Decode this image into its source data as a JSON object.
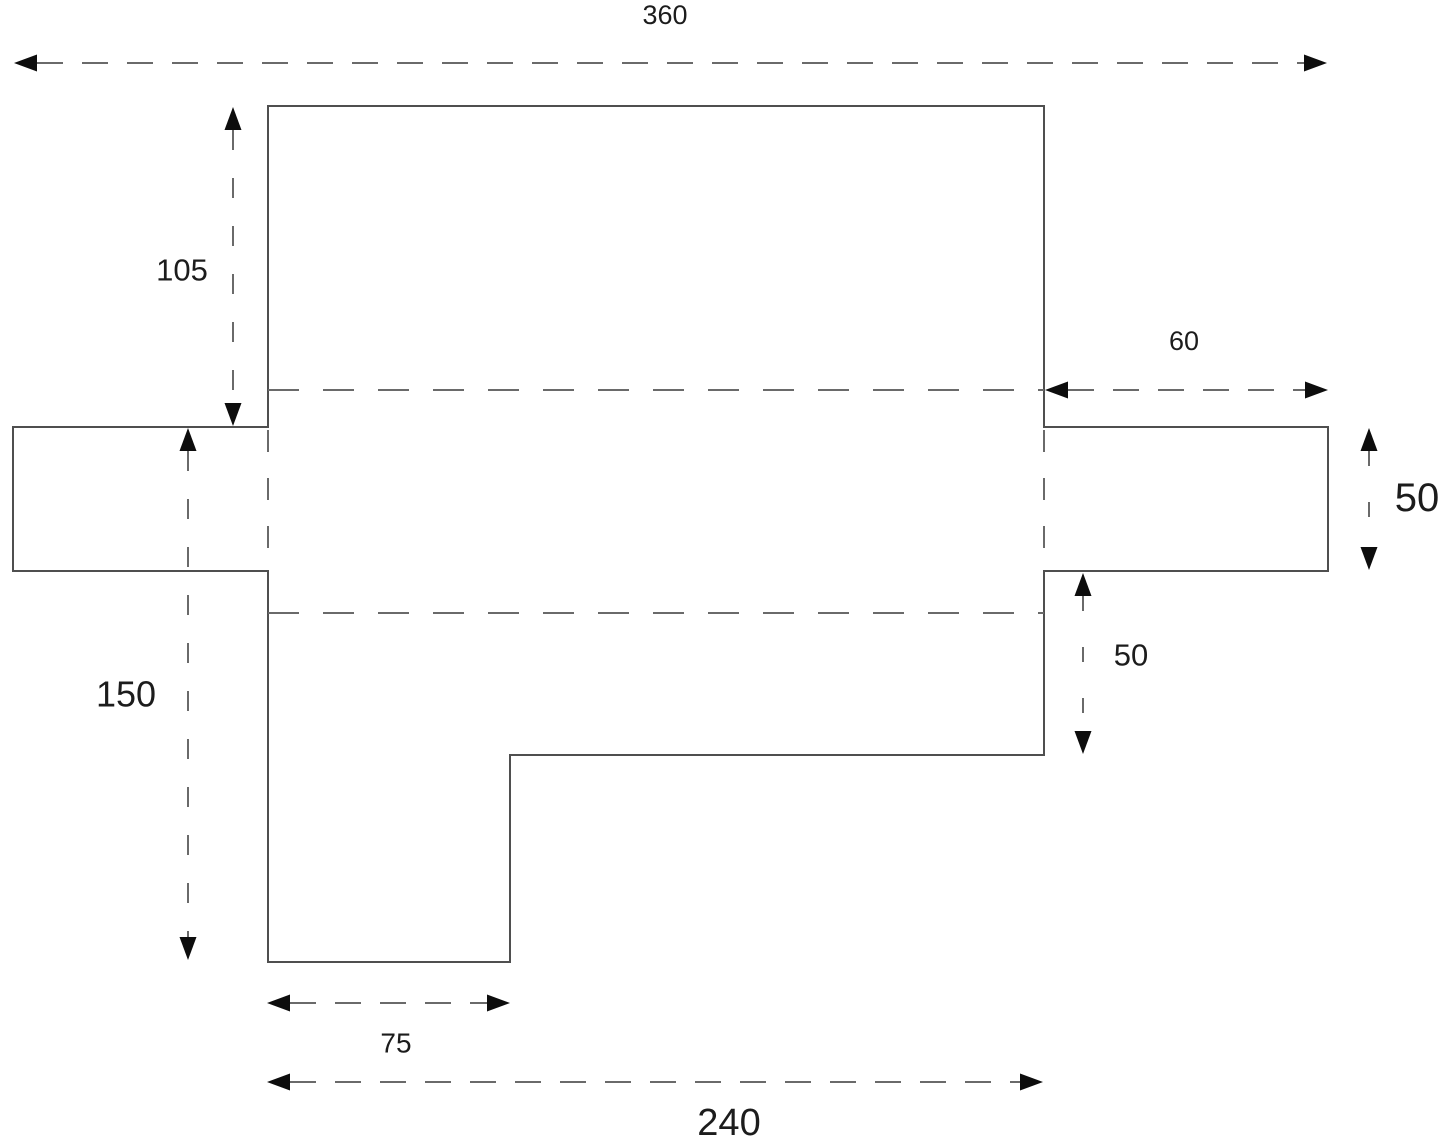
{
  "page": {
    "width": 1445,
    "height": 1146,
    "background": "#ffffff"
  },
  "colors": {
    "outline": "#4f4f4f",
    "dash": "#6a6a6a",
    "arrow": "#0d0d0d",
    "label": "#1c1c1c"
  },
  "shape": {
    "name": "stepped-plate-outline",
    "points": [
      [
        268,
        106
      ],
      [
        1044,
        106
      ],
      [
        1044,
        427
      ],
      [
        1328,
        427
      ],
      [
        1328,
        571
      ],
      [
        1044,
        571
      ],
      [
        1044,
        755
      ],
      [
        510,
        755
      ],
      [
        510,
        962
      ],
      [
        268,
        962
      ],
      [
        268,
        571
      ],
      [
        13,
        571
      ],
      [
        13,
        427
      ],
      [
        268,
        427
      ]
    ]
  },
  "guides": [
    {
      "name": "upper-horizontal-guide",
      "x1": 268,
      "y1": 390,
      "x2": 1044,
      "y2": 390,
      "dash": "dash-guide"
    },
    {
      "name": "lower-horizontal-guide",
      "x1": 268,
      "y1": 613,
      "x2": 1044,
      "y2": 613,
      "dash": "dash-guide"
    },
    {
      "name": "left-tab-vertical-guide",
      "x1": 268,
      "y1": 430,
      "x2": 268,
      "y2": 569,
      "dash": "dash-vguide"
    },
    {
      "name": "right-tab-vertical-guide",
      "x1": 1044,
      "y1": 430,
      "x2": 1044,
      "y2": 569,
      "dash": "dash-vguide"
    }
  ],
  "dimensions": [
    {
      "id": "width-360",
      "label": "360",
      "orientation": "h",
      "pos": 63,
      "from": 14,
      "to": 1327,
      "dash": "dash-h",
      "label_x": 665,
      "label_y": 15,
      "font_size": 27
    },
    {
      "id": "height-105",
      "label": "105",
      "orientation": "v",
      "pos": 233,
      "from": 107,
      "to": 426,
      "dash": "dash-v",
      "label_x": 182,
      "label_y": 270,
      "font_size": 31
    },
    {
      "id": "height-150",
      "label": "150",
      "orientation": "v",
      "pos": 188,
      "from": 428,
      "to": 960,
      "dash": "dash-v",
      "label_x": 126,
      "label_y": 694,
      "font_size": 36
    },
    {
      "id": "width-60",
      "label": "60",
      "orientation": "h",
      "pos": 390,
      "from": 1045,
      "to": 1328,
      "dash": "dash-h",
      "label_x": 1184,
      "label_y": 341,
      "font_size": 27
    },
    {
      "id": "height-50-right",
      "label": "50",
      "orientation": "v",
      "pos": 1369,
      "from": 428,
      "to": 570,
      "dash": "dash-vs",
      "label_x": 1417,
      "label_y": 498,
      "font_size": 40
    },
    {
      "id": "height-50-inner",
      "label": "50",
      "orientation": "v",
      "pos": 1083,
      "from": 573,
      "to": 754,
      "dash": "dash-vs",
      "label_x": 1131,
      "label_y": 655,
      "font_size": 31
    },
    {
      "id": "width-75",
      "label": "75",
      "orientation": "h",
      "pos": 1003,
      "from": 267,
      "to": 510,
      "dash": "dash-h",
      "label_x": 396,
      "label_y": 1043,
      "font_size": 28
    },
    {
      "id": "width-240",
      "label": "240",
      "orientation": "h",
      "pos": 1082,
      "from": 267,
      "to": 1043,
      "dash": "dash-h",
      "label_x": 729,
      "label_y": 1123,
      "font_size": 38
    }
  ]
}
